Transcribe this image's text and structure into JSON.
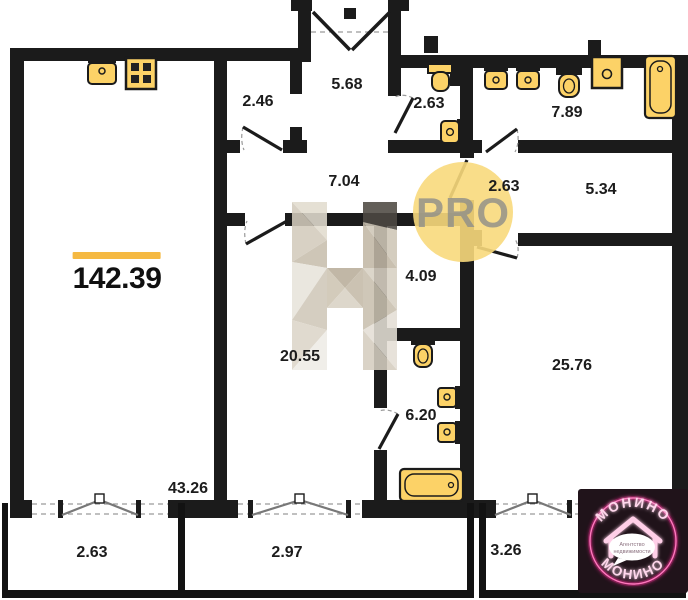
{
  "plan": {
    "total_area_label": "142.39",
    "watermark_pro": "PRO",
    "watermark_letter": "H"
  },
  "rooms": {
    "hall_entry": {
      "area": "5.68"
    },
    "hallway_small": {
      "area": "2.46"
    },
    "wc_top": {
      "area": "2.63"
    },
    "bathroom_top": {
      "area": "7.89"
    },
    "corridor": {
      "area": "7.04"
    },
    "hall_inner": {
      "area": "2.63"
    },
    "wardrobe": {
      "area": "5.34"
    },
    "room_small": {
      "area": "4.09"
    },
    "bedroom_mid": {
      "area": "20.55"
    },
    "bathroom_mid": {
      "area": "6.20"
    },
    "bedroom_right": {
      "area": "25.76"
    },
    "living_kitchen": {
      "area": "43.26"
    },
    "balcony_left": {
      "area": "2.63"
    },
    "balcony_mid": {
      "area": "2.97"
    },
    "balcony_right": {
      "area": "3.26"
    }
  },
  "logo": {
    "brand_top": "МОНИНО",
    "brand_bottom": "МОНИНО",
    "tagline_line1": "Агентство",
    "tagline_line2": "недвижимости"
  },
  "colors": {
    "wall": "#1b1b1b",
    "fixture_yellow": "#fcd267",
    "accent_line": "#f5b942",
    "pro_circle": "#f8d97c",
    "logo_pink": "#ff2e9a"
  }
}
